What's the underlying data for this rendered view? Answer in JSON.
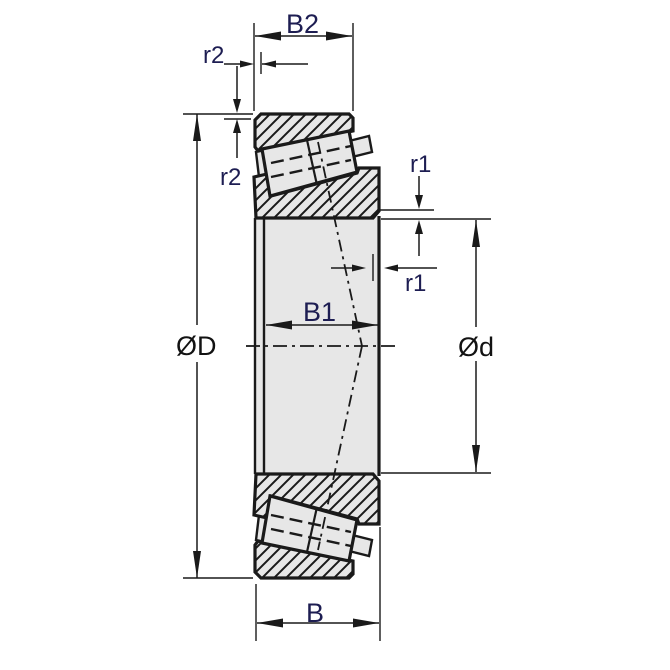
{
  "diagram": {
    "type": "technical-drawing",
    "subject": "tapered-roller-bearing-cross-section",
    "labels": {
      "cup_width": "B2",
      "cone_width": "B1",
      "total_width": "B",
      "outer_diameter": "ØD",
      "bore_diameter": "Ød",
      "cup_chamfer": "r2",
      "cone_chamfer": "r1"
    },
    "colors": {
      "line": "#1a1a1a",
      "fill_gray": "#e7e7e7",
      "label_blue": "#1d1d52",
      "label_black": "#121212",
      "background": "#ffffff"
    }
  }
}
